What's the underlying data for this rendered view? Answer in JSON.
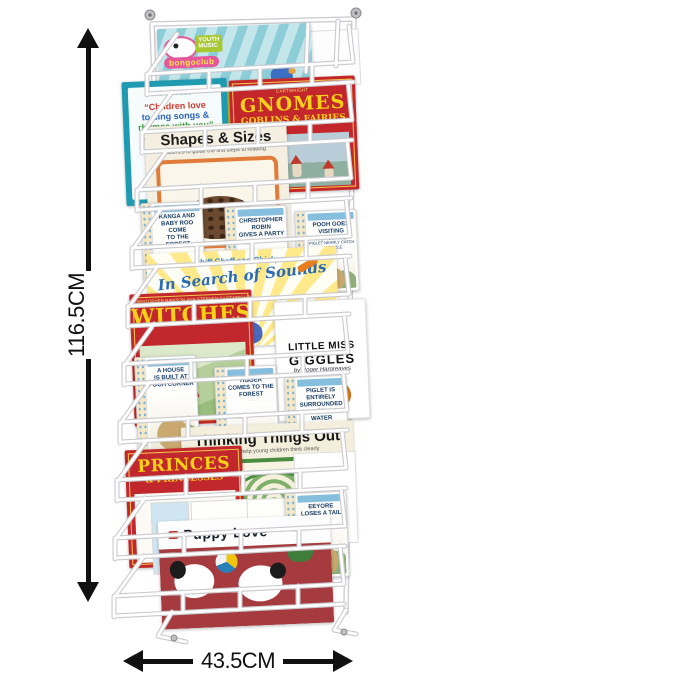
{
  "image_type": "product photo of a wall-mounted wire book display rack with dimension annotations",
  "dimensions": {
    "height_label": "116.5CM",
    "width_label": "43.5CM"
  },
  "rack": {
    "description": "white wall-mounted 10-tier wire literature rack filled with children's books",
    "wire_color": "#ffffff",
    "arrow_color": "#111111"
  },
  "books": {
    "bongo": {
      "brand1": "YOUTH",
      "brand2": "MUSIC",
      "club": "bongoclub"
    },
    "children_love": {
      "header": "SureStart",
      "l1": "“Children love",
      "l2": "to sing songs &",
      "l3": "rhymes with you”"
    },
    "phonics": {
      "t1": "ar",
      "t2": "ee"
    },
    "gnomes": {
      "author": "CHRISTOPHER RAWSON AND STEPHEN CARTWRIGHT",
      "title": "GNOMES",
      "subtitle": "GOBLINS & FAIRIES"
    },
    "shapes": {
      "title": "Shapes & Sizes",
      "subtitle": "Games to guide the first steps to reading"
    },
    "pooh_row1": [
      {
        "l1": "KANGA AND",
        "l2": "BABY ROO COME",
        "l3": "TO THE FOREST"
      },
      {
        "l1": "CHRISTOPHER",
        "l2": "ROBIN",
        "l3": "GIVES A PARTY"
      },
      {
        "l1": "POOH GOES",
        "l2": "VISITING",
        "l3": "AND POOH AND PIGLET NEARLY CATCH A WOOZLE"
      }
    ],
    "sounds": {
      "script": "Chiff Chaff and Chickpea",
      "title": "In Search of Sounds"
    },
    "witches": {
      "author": "CHRISTOPHER RAWSON AND STEPHEN CARTWRIGHT",
      "title": "WITCHES"
    },
    "giggles": {
      "l1": "LITTLE MISS",
      "l2": "GIGGLES",
      "byline": "by Roger Hargreaves"
    },
    "pooh_row2": [
      {
        "l1": "A HOUSE",
        "l2": "IS BUILT AT",
        "l3": "POOH CORNER"
      },
      {
        "l1": "TIGGER",
        "l2": "COMES TO THE",
        "l3": "FOREST"
      },
      {
        "l1": "PIGLET IS ENTIRELY",
        "l2": "SURROUNDED BY",
        "l3": "WATER"
      }
    ],
    "thinking": {
      "title": "Thinking Things Out",
      "subtitle": "Games to help young children think clearly"
    },
    "princes": {
      "title": "PRINCES",
      "subtitle": "& PRINCESSES"
    },
    "pooh_row3": [
      {
        "l1": "EEYORE",
        "l2": "LOSES A TAIL"
      }
    ],
    "puppy": {
      "title": "Puppy Love"
    }
  }
}
